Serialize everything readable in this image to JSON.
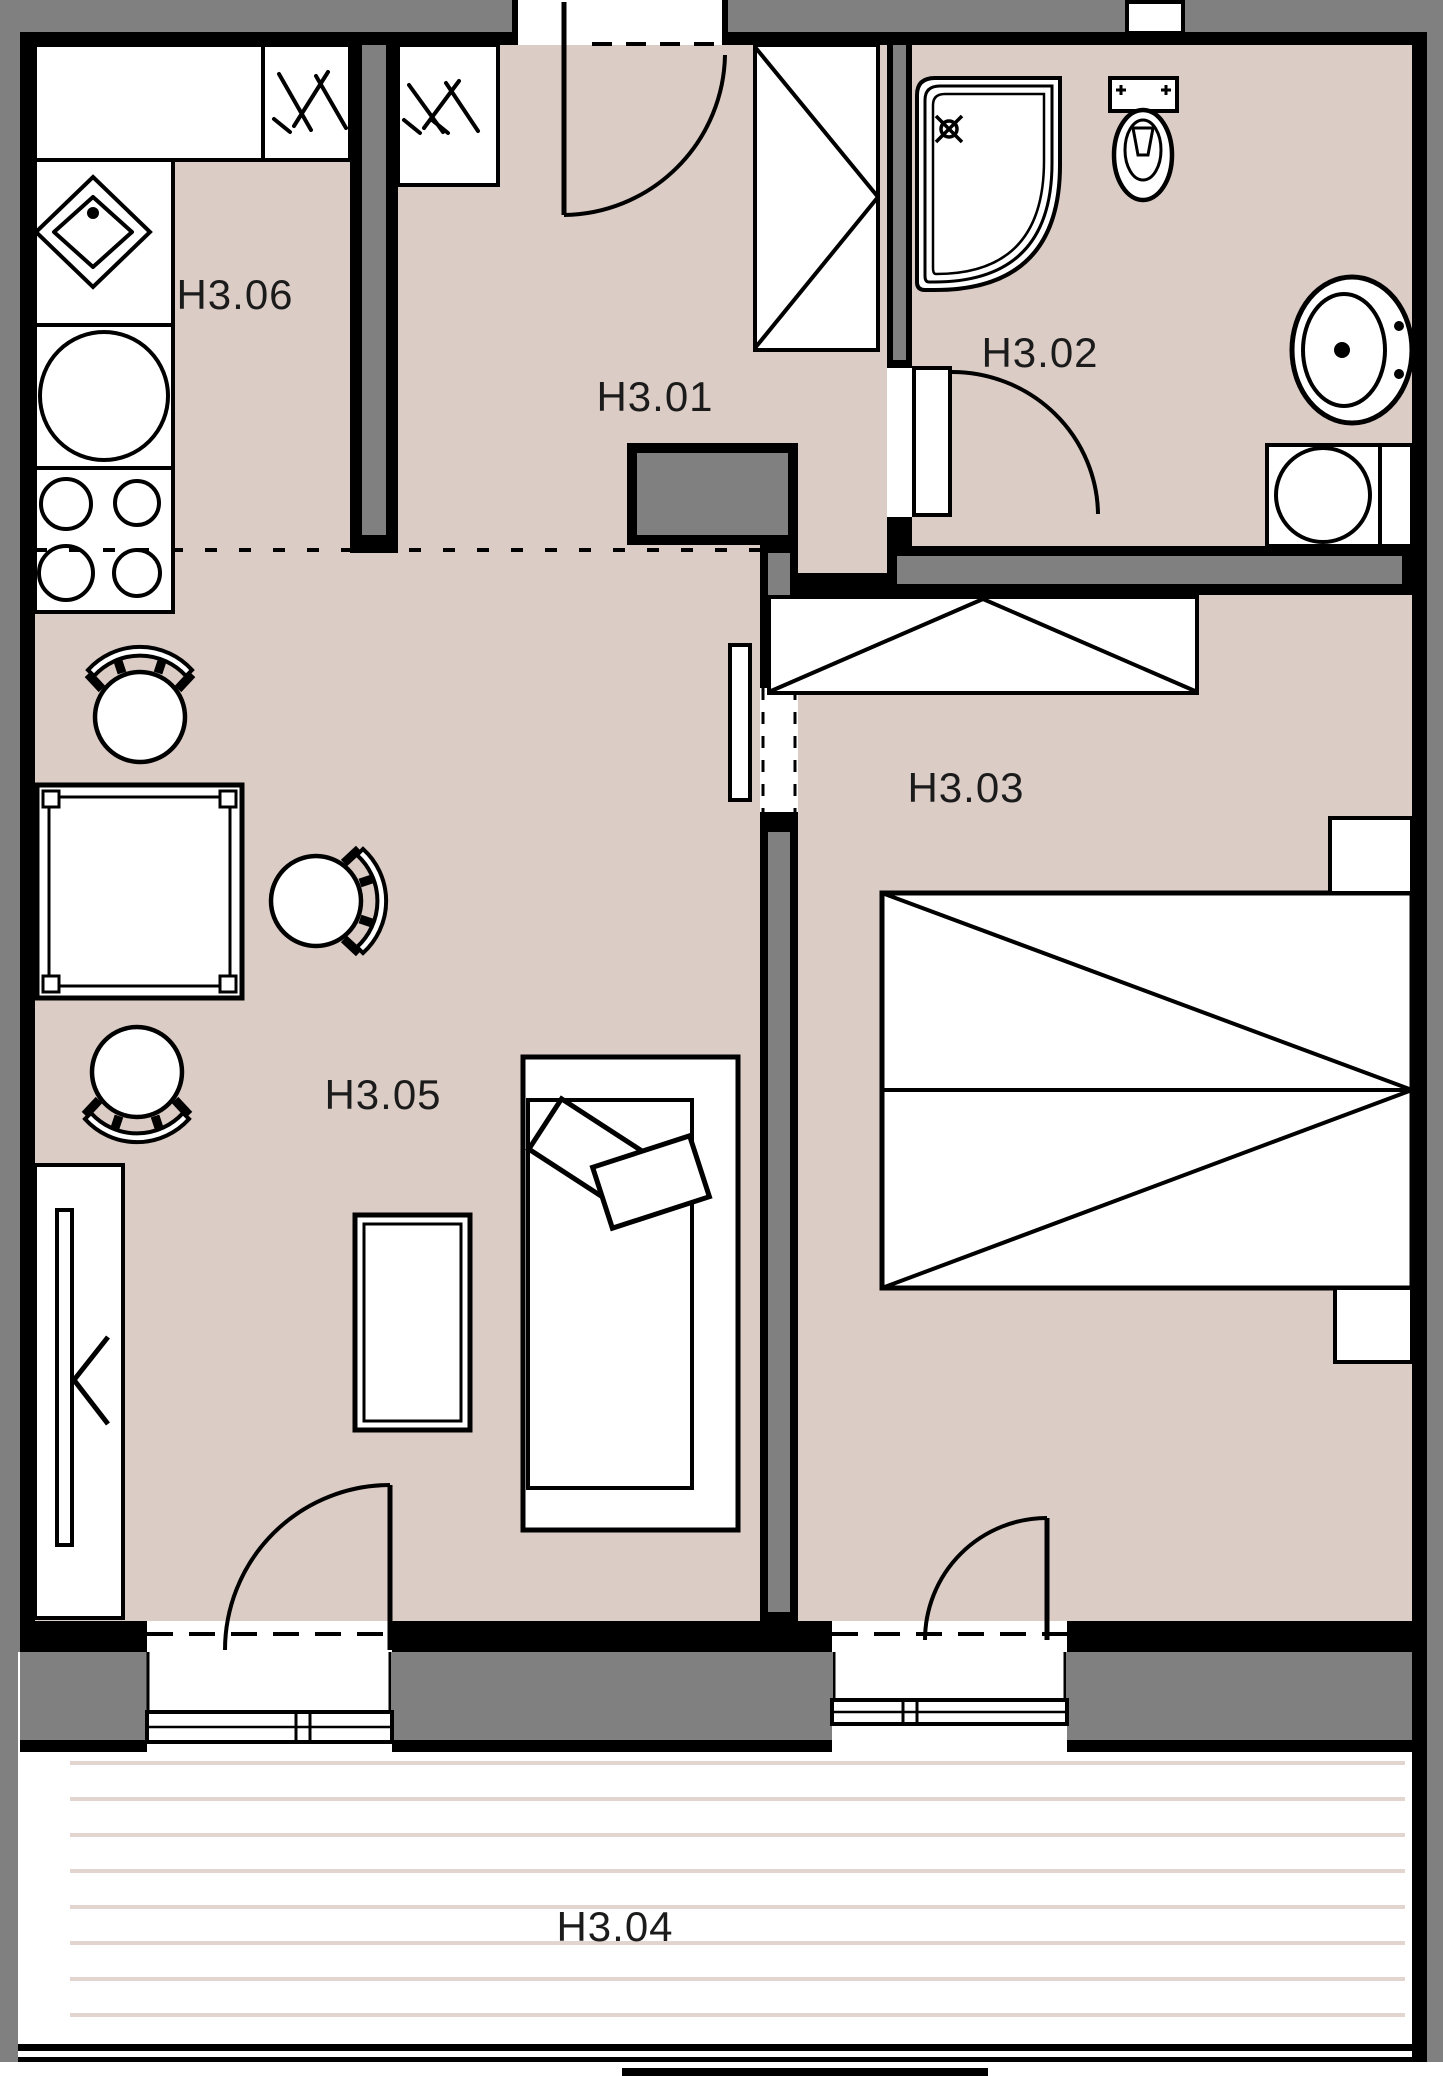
{
  "document": {
    "type": "architectural-floor-plan",
    "unit": "H3",
    "view": "top-down plan with balcony"
  },
  "colors": {
    "floor": "#dbccc5",
    "wall_core_gray": "#808080",
    "wall_line": "#000000",
    "balcony_stripe": "#e2d5cf",
    "fixture_fill": "#ffffff",
    "label_text": "#1b1b1b"
  },
  "rooms": [
    {
      "id": "hall",
      "label": "H3.01"
    },
    {
      "id": "bathroom",
      "label": "H3.02"
    },
    {
      "id": "bedroom",
      "label": "H3.03"
    },
    {
      "id": "balcony",
      "label": "H3.04"
    },
    {
      "id": "living-room",
      "label": "H3.05"
    },
    {
      "id": "kitchen",
      "label": "H3.06"
    }
  ],
  "furniture": [
    "kitchen-counter",
    "kitchen-sink",
    "fridge",
    "cooktop-4-burners",
    "utility-shaft-kitchen",
    "utility-shaft-hall",
    "dining-table",
    "dining-chair",
    "dining-chair",
    "dining-chair",
    "tv-sideboard",
    "coffee-table",
    "sofa-with-pillows",
    "entrance-door",
    "hall-wardrobe",
    "sliding-pocket-door",
    "shower-corner",
    "toilet",
    "washbasin",
    "washing-machine",
    "bathroom-door",
    "bedroom-wardrobe",
    "double-bed",
    "nightstand",
    "nightstand",
    "balcony-door-living",
    "balcony-door-bedroom",
    "balcony-railing"
  ]
}
